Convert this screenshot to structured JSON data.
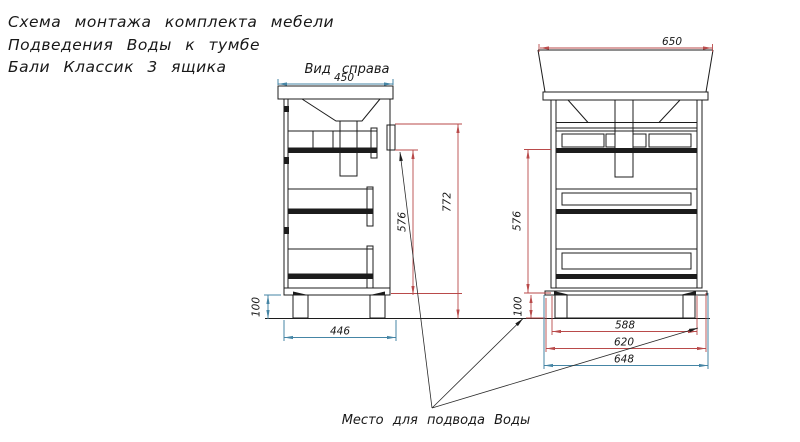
{
  "title": {
    "line1": "Схема монтажа комплекта мебели",
    "line2": "Подведения Воды к тумбе",
    "line3": "Бали Классик 3 ящика"
  },
  "left_view": {
    "label": "Вид справа",
    "dims": {
      "top_width": "450",
      "base_width": "446",
      "leg_height": "100",
      "supply_height": "576",
      "total_height": "772"
    }
  },
  "right_view": {
    "dims": {
      "top_width": "650",
      "supply_height": "576",
      "leg_height": "100",
      "feet_span": "588",
      "body_width": "620",
      "total_width": "648"
    }
  },
  "note": "Место для подвода Воды",
  "colors": {
    "drawing_line": "#1c1c1c",
    "dim_red": "#b94a4a",
    "dim_teal": "#4585a5",
    "background": "#ffffff"
  }
}
